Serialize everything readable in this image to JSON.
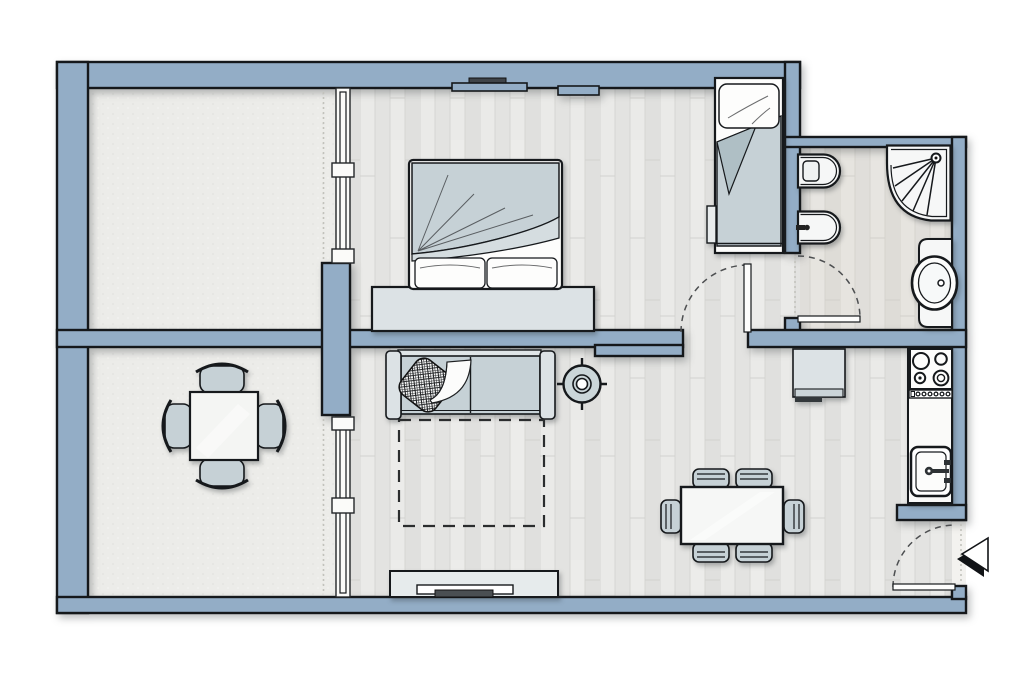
{
  "canvas": {
    "width": 1030,
    "height": 689,
    "background": "#ffffff"
  },
  "palette": {
    "bg": "#ffffff",
    "wall": "#93ADC6",
    "wall_outline": "#15181b",
    "stucco": "#ECECE9",
    "wood_light": "#EAEAE8",
    "wood_dark": "#E2E2E0",
    "wood_line": "#D6D6D3",
    "bath_tint": "#D6CFC0",
    "fixture_white": "#F6F7F7",
    "upholstery": "#C6D1D6",
    "upholstery_dark": "#AFBFC5",
    "furniture_light": "#DCE2E5",
    "tv_dark": "#4A4F52",
    "swing": "#4d4f51",
    "dotted": "#C2C2BC",
    "shelf_dark": "#3F4449"
  },
  "plan": {
    "type": "apartment-floor-plan",
    "rooms": [
      "balcony-north",
      "balcony-south",
      "bedroom",
      "bathroom",
      "hallway",
      "living-dining-room",
      "kitchen"
    ],
    "fixtures": [
      "double-bed",
      "single-bed",
      "wall-shelf",
      "toilet",
      "bidet",
      "corner-shower",
      "washbasin",
      "console-desk",
      "sofa",
      "throw-pillow",
      "throw-blanket",
      "ceiling-light",
      "rug",
      "tv-cabinet",
      "tv",
      "dining-table",
      "dining-chairs-x6",
      "balcony-table",
      "balcony-chairs-x4",
      "kitchen-counter",
      "stove-4-burners",
      "kitchen-sink"
    ],
    "doors": [
      "bedroom-door",
      "bathroom-door",
      "entry-door"
    ],
    "windows": [
      "glazed-partition-north",
      "glazed-partition-south"
    ],
    "markers": [
      "entrance-arrow"
    ]
  }
}
